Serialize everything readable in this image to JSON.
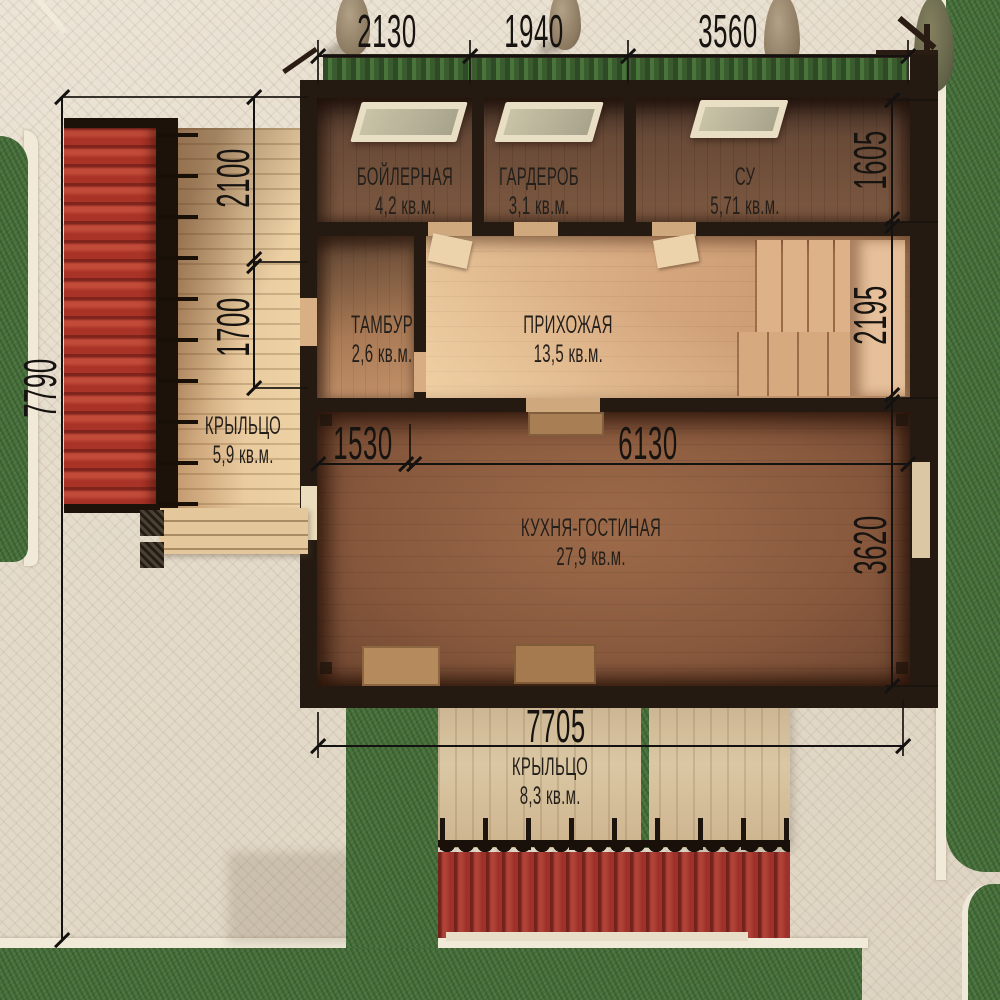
{
  "plan": {
    "type": "floor-plan-render",
    "floor_note": "first floor plan, top-down 3D render"
  },
  "rooms": [
    {
      "name": "БОЙЛЕРНАЯ",
      "area": "4,2 кв.м."
    },
    {
      "name": "ГАРДЕРОБ",
      "area": "3,1 кв.м."
    },
    {
      "name": "СУ",
      "area": "5,71 кв.м."
    },
    {
      "name": "ТАМБУР",
      "area": "2,6 кв.м."
    },
    {
      "name": "ПРИХОЖАЯ",
      "area": "13,5 кв.м."
    },
    {
      "name": "КУХНЯ-ГОСТИНАЯ",
      "area": "27,9 кв.м."
    },
    {
      "name": "КРЫЛЬЦО",
      "area": "5,9 кв.м."
    },
    {
      "name": "КРЫЛЬЦО",
      "area": "8,3 кв.м."
    }
  ],
  "dimensions_mm": {
    "top": [
      "2130",
      "1940",
      "3560"
    ],
    "right": [
      "1605",
      "2195",
      "3620"
    ],
    "left_outer": "7790",
    "left_inner": [
      "2100",
      "1700"
    ],
    "kitchen": [
      "1530",
      "6130"
    ],
    "bottom": "7705"
  },
  "colors": {
    "roof_red": "#a93327",
    "grass_green": "#47703b",
    "paving": "#e4dbca",
    "timber_wall": "#241a12",
    "kitchen_floor": "#8a5a3e",
    "hall_floor": "#d6a77e",
    "deck_wood": "#e6c89e",
    "dimension_ink": "#141210"
  }
}
